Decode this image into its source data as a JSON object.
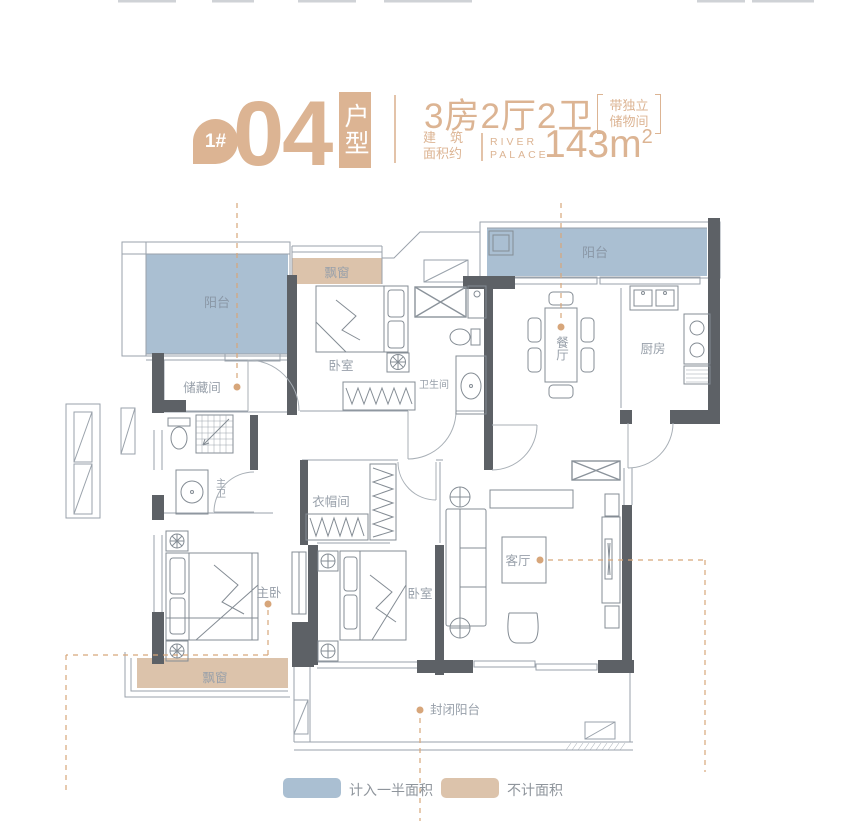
{
  "header": {
    "badge": "1#",
    "unit_number": "04",
    "unit_type_label": "户型",
    "layout_spec": "3房2厅2卫",
    "note_line1": "带独立",
    "note_line2": "储物间",
    "area_label_line1": "建筑",
    "area_label_line2": "面积约",
    "brand_line1": "RIVER",
    "brand_line2": "PALACE",
    "area_value": "143m",
    "area_superscript": "2"
  },
  "floorplan": {
    "rooms": {
      "balcony_left": "阳台",
      "balcony_right": "阳台",
      "bay_window_top": "飘窗",
      "bedroom_top": "卧室",
      "storage": "储藏间",
      "bathroom": "卫生间",
      "dining": "餐厅",
      "kitchen": "厨房",
      "master_bath": "主卫",
      "cloakroom": "衣帽间",
      "master_bedroom": "主卧",
      "bedroom_bottom": "卧室",
      "living": "客厅",
      "bay_window_bottom": "飘窗",
      "enclosed_balcony": "封闭阳台"
    }
  },
  "legend": {
    "half_area_label": "计入一半面积",
    "excluded_label": "不计面积"
  },
  "colors": {
    "accent": "#dcb493",
    "half_area_fill": "#aabfd2",
    "excluded_fill": "#dcc3ab",
    "wall": "#5d6166",
    "room_label": "#98a0aa",
    "marker": "#d7a67a"
  }
}
